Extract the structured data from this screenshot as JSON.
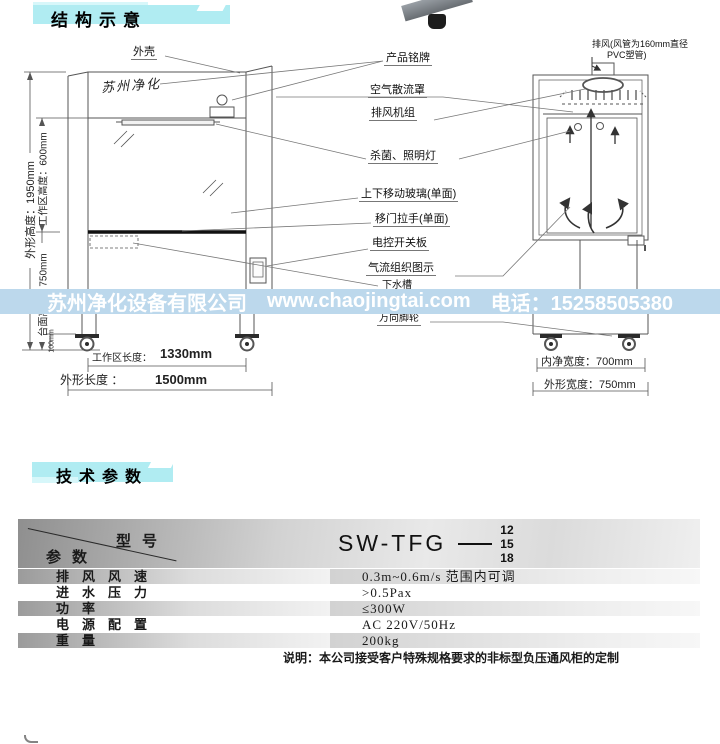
{
  "colors": {
    "header_accent": "#b0ecf2",
    "banner_bg": "#bcd8ec",
    "banner_text": "#ffffff"
  },
  "sections": {
    "structure_title": "结构示意",
    "specs_title": "技术参数"
  },
  "diagram": {
    "brand_text": "苏州净化",
    "labels": {
      "outer_shell": "外壳",
      "nameplate": "产品铭牌",
      "air_diffuser": "空气散流罩",
      "exhaust_fan_unit": "排风机组",
      "uv_lighting": "杀菌、照明灯",
      "moving_glass": "上下移动玻璃(单面)",
      "door_handle": "移门拉手(单面)",
      "switch_panel": "电控开关板",
      "airflow_diagram": "气流组织图示",
      "sink": "下水槽",
      "casters": "万向脚轮",
      "exhaust_note_1": "排风(风管为160mm直径",
      "exhaust_note_2": "PVC塑管)"
    },
    "dimensions": {
      "overall_height": "外形高度：1950mm",
      "work_area_height": "工作区高度：600mm",
      "worktop_height": "台面高度：750mm",
      "base_height": "100mm",
      "work_area_length_label": "工作区长度：",
      "work_area_length_value": "1330mm",
      "overall_length_label": "外形长度 ：",
      "overall_length_value": "1500mm",
      "inner_width": "内净宽度：700mm",
      "overall_width": "外形宽度：750mm"
    }
  },
  "banner": {
    "company": "苏州净化设备有限公司",
    "website": "www.chaojingtai.com",
    "phone": "电话：15258505380"
  },
  "specs": {
    "table": {
      "header": {
        "model_label": "型号",
        "param_label": "参数",
        "model_name": "SW-TFG",
        "model_sizes": [
          "12",
          "15",
          "18"
        ]
      },
      "rows": [
        {
          "label": "排风风速",
          "value": "0.3m~0.6m/s 范围内可调"
        },
        {
          "label": "进水压力",
          "value": ">0.5Pax"
        },
        {
          "label": "功率",
          "value": "≤300W"
        },
        {
          "label": "电源配置",
          "value": "AC 220V/50Hz"
        },
        {
          "label": "重量",
          "value": "200kg"
        }
      ],
      "note": "说明：本公司接受客户特殊规格要求的非标型负压通风柜的定制"
    }
  }
}
